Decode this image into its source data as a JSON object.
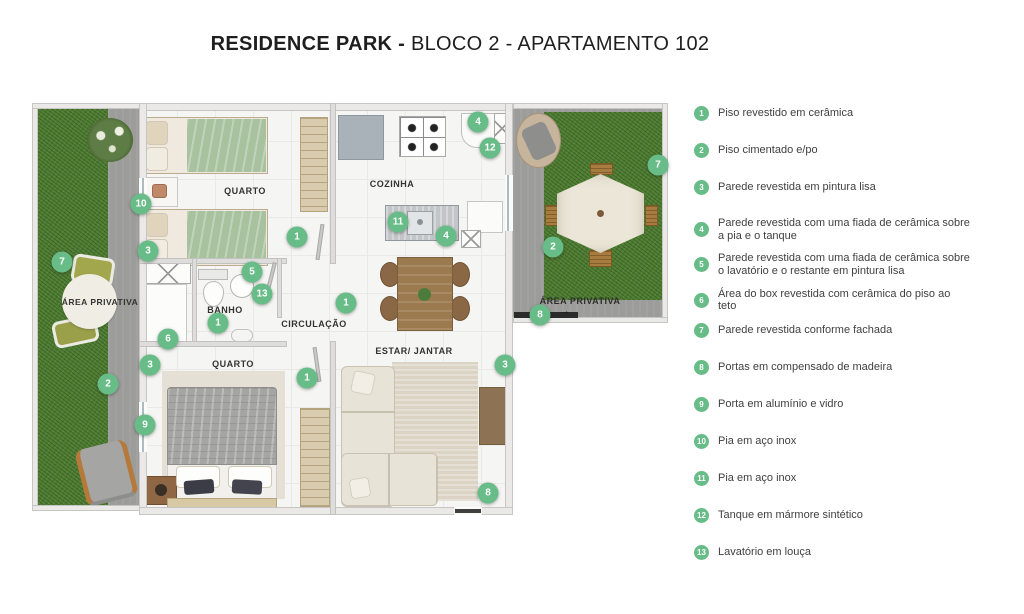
{
  "title": {
    "brand": "RESIDENCE PARK -",
    "rest": " BLOCO 2 - APARTAMENTO 102"
  },
  "colors": {
    "marker_green": "#68bc87",
    "grass": "#4e7c34",
    "concrete": "#9c9c9a"
  },
  "legend": {
    "items": [
      {
        "num": "1",
        "text": "Piso revestido em cerâmica"
      },
      {
        "num": "2",
        "text": "Piso cimentado e/po"
      },
      {
        "num": "3",
        "text": "Parede revestida em pintura lisa"
      },
      {
        "num": "4",
        "text": "Parede revestida com uma fiada de cerâmica sobre\na pia e o tanque"
      },
      {
        "num": "5",
        "text": "Parede revestida com uma fiada de cerâmica sobre\no lavatório e o restante em pintura lisa"
      },
      {
        "num": "6",
        "text": "Área do box revestida com cerâmica do piso ao\nteto"
      },
      {
        "num": "7",
        "text": "Parede revestida conforme fachada"
      },
      {
        "num": "8",
        "text": "Portas em compensado de madeira"
      },
      {
        "num": "9",
        "text": "Porta em alumínio e vidro"
      },
      {
        "num": "10",
        "text": "Pia em aço inox"
      },
      {
        "num": "11",
        "text": "Pia em aço inox"
      },
      {
        "num": "12",
        "text": "Tanque em mármore sintético"
      },
      {
        "num": "13",
        "text": "Lavatório em louça"
      }
    ]
  },
  "plan": {
    "labels": {
      "quarto1": "QUARTO",
      "cozinha": "COZINHA",
      "banho": "BANHO",
      "circulacao": "CIRCULAÇÃO",
      "quarto2": "QUARTO",
      "estar": "ESTAR/ JANTAR",
      "area_privativa_left": "ÁREA PRIVATIVA",
      "area_privativa_right": "ÁREA PRIVATIVA"
    },
    "entry_arrow": "→",
    "markers": [
      {
        "num": "7",
        "x": 62,
        "y": 262
      },
      {
        "num": "10",
        "x": 141,
        "y": 204
      },
      {
        "num": "3",
        "x": 148,
        "y": 251
      },
      {
        "num": "2",
        "x": 108,
        "y": 384
      },
      {
        "num": "9",
        "x": 145,
        "y": 425
      },
      {
        "num": "1",
        "x": 297,
        "y": 237
      },
      {
        "num": "5",
        "x": 252,
        "y": 272
      },
      {
        "num": "13",
        "x": 262,
        "y": 294
      },
      {
        "num": "1",
        "x": 218,
        "y": 323
      },
      {
        "num": "6",
        "x": 168,
        "y": 339
      },
      {
        "num": "3",
        "x": 150,
        "y": 365
      },
      {
        "num": "1",
        "x": 307,
        "y": 378
      },
      {
        "num": "1",
        "x": 346,
        "y": 303
      },
      {
        "num": "11",
        "x": 398,
        "y": 222
      },
      {
        "num": "4",
        "x": 446,
        "y": 236
      },
      {
        "num": "4",
        "x": 478,
        "y": 122
      },
      {
        "num": "12",
        "x": 490,
        "y": 148
      },
      {
        "num": "2",
        "x": 553,
        "y": 247
      },
      {
        "num": "7",
        "x": 658,
        "y": 165
      },
      {
        "num": "8",
        "x": 540,
        "y": 315
      },
      {
        "num": "3",
        "x": 505,
        "y": 365
      },
      {
        "num": "8",
        "x": 488,
        "y": 493
      }
    ]
  }
}
